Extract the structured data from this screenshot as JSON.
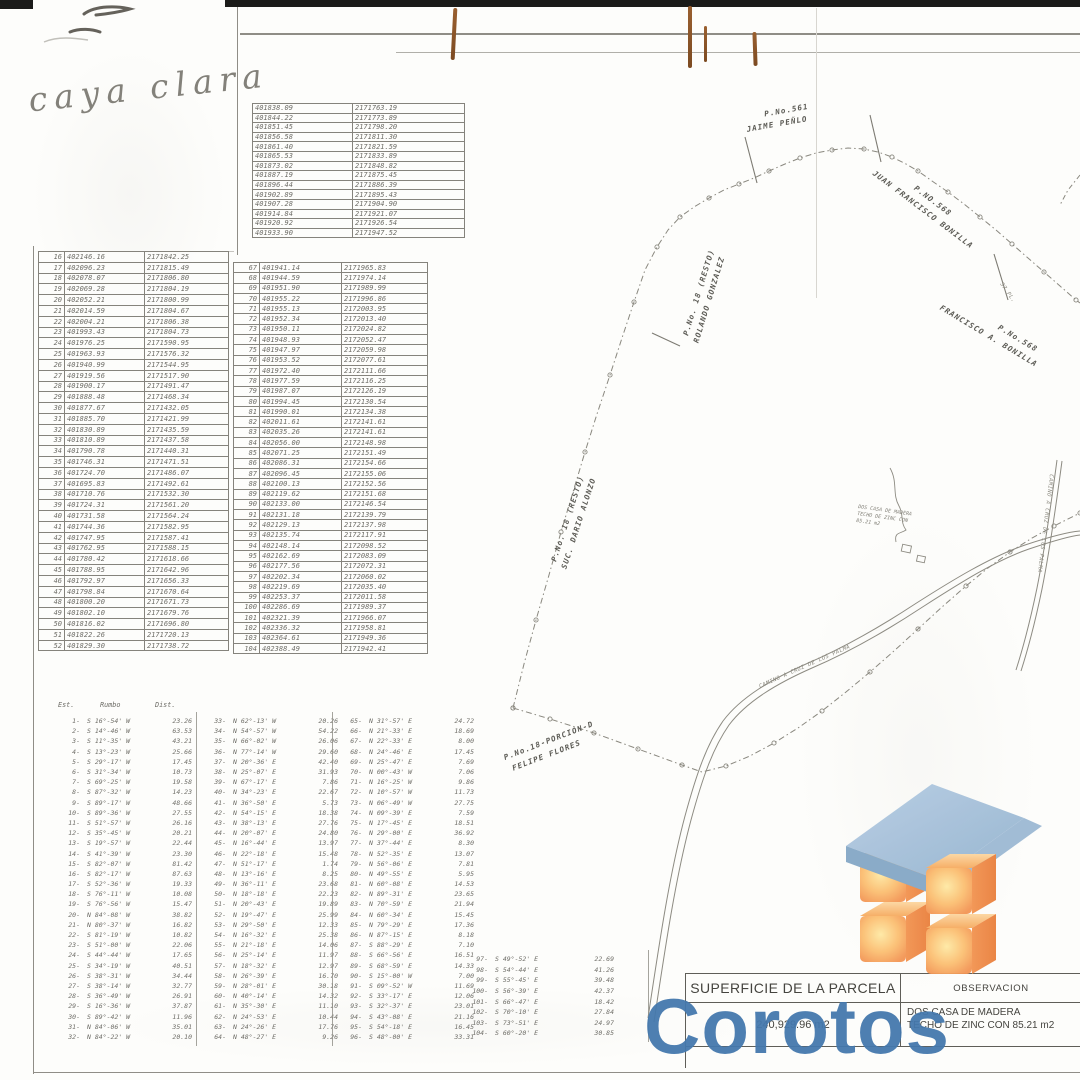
{
  "handwriting": {
    "text": "caya clara"
  },
  "top_table": {
    "rows": [
      [
        "401838.09",
        "2171763.19"
      ],
      [
        "401844.22",
        "2171773.89"
      ],
      [
        "401851.45",
        "2171798.20"
      ],
      [
        "401856.58",
        "2171811.30"
      ],
      [
        "401861.40",
        "2171821.59"
      ],
      [
        "401865.53",
        "2171833.89"
      ],
      [
        "401873.02",
        "2171848.82"
      ],
      [
        "401887.19",
        "2171875.45"
      ],
      [
        "401896.44",
        "2171886.39"
      ],
      [
        "401902.89",
        "2171895.43"
      ],
      [
        "401907.28",
        "2171904.90"
      ],
      [
        "401914.84",
        "2171921.07"
      ],
      [
        "401920.92",
        "2171926.54"
      ],
      [
        "401933.90",
        "2171947.52"
      ]
    ]
  },
  "left_table": {
    "rows": [
      [
        "16",
        "402146.16",
        "2171842.25"
      ],
      [
        "17",
        "402096.23",
        "2171815.49"
      ],
      [
        "18",
        "402078.07",
        "2171806.80"
      ],
      [
        "19",
        "402069.28",
        "2171804.19"
      ],
      [
        "20",
        "402052.21",
        "2171800.99"
      ],
      [
        "21",
        "402014.59",
        "2171804.67"
      ],
      [
        "22",
        "402004.21",
        "2171806.38"
      ],
      [
        "23",
        "401993.43",
        "2171804.73"
      ],
      [
        "24",
        "401976.25",
        "2171590.95"
      ],
      [
        "25",
        "401963.93",
        "2171576.32"
      ],
      [
        "26",
        "401940.99",
        "2171544.95"
      ],
      [
        "27",
        "401919.56",
        "2171517.90"
      ],
      [
        "28",
        "401900.17",
        "2171491.47"
      ],
      [
        "29",
        "401888.48",
        "2171468.34"
      ],
      [
        "30",
        "401877.67",
        "2171432.05"
      ],
      [
        "31",
        "401885.70",
        "2171421.99"
      ],
      [
        "32",
        "401830.89",
        "2171435.59"
      ],
      [
        "33",
        "401810.89",
        "2171437.58"
      ],
      [
        "34",
        "401790.78",
        "2171440.31"
      ],
      [
        "35",
        "401746.31",
        "2171471.51"
      ],
      [
        "36",
        "401724.70",
        "2171486.07"
      ],
      [
        "37",
        "401695.83",
        "2171492.61"
      ],
      [
        "38",
        "401710.76",
        "2171532.30"
      ],
      [
        "39",
        "401724.31",
        "2171561.20"
      ],
      [
        "40",
        "401731.58",
        "2171564.24"
      ],
      [
        "41",
        "401744.36",
        "2171582.95"
      ],
      [
        "42",
        "401747.95",
        "2171587.41"
      ],
      [
        "43",
        "401762.95",
        "2171588.15"
      ],
      [
        "44",
        "401780.42",
        "2171618.66"
      ],
      [
        "45",
        "401788.95",
        "2171642.96"
      ],
      [
        "46",
        "401792.97",
        "2171656.33"
      ],
      [
        "47",
        "401798.84",
        "2171670.64"
      ],
      [
        "48",
        "401800.20",
        "2171671.73"
      ],
      [
        "49",
        "401802.10",
        "2171679.76"
      ],
      [
        "50",
        "401816.02",
        "2171696.80"
      ],
      [
        "51",
        "401822.26",
        "2171720.13"
      ],
      [
        "52",
        "401829.30",
        "2171738.72"
      ]
    ]
  },
  "mid_table": {
    "rows": [
      [
        "67",
        "401941.14",
        "2171965.83"
      ],
      [
        "68",
        "401944.59",
        "2171974.14"
      ],
      [
        "69",
        "401951.90",
        "2171989.99"
      ],
      [
        "70",
        "401955.22",
        "2171996.86"
      ],
      [
        "71",
        "401955.13",
        "2172003.95"
      ],
      [
        "72",
        "401952.34",
        "2172013.40"
      ],
      [
        "73",
        "401950.11",
        "2172024.82"
      ],
      [
        "74",
        "401948.93",
        "2172052.47"
      ],
      [
        "75",
        "401947.97",
        "2172059.98"
      ],
      [
        "76",
        "401953.52",
        "2172077.61"
      ],
      [
        "77",
        "401972.40",
        "2172111.66"
      ],
      [
        "78",
        "401977.59",
        "2172116.25"
      ],
      [
        "79",
        "401987.07",
        "2172126.19"
      ],
      [
        "80",
        "401994.45",
        "2172130.54"
      ],
      [
        "81",
        "401990.01",
        "2172134.38"
      ],
      [
        "82",
        "402011.61",
        "2172141.61"
      ],
      [
        "83",
        "402035.26",
        "2172141.61"
      ],
      [
        "84",
        "402056.00",
        "2172148.98"
      ],
      [
        "85",
        "402071.25",
        "2172151.49"
      ],
      [
        "86",
        "402086.31",
        "2172154.66"
      ],
      [
        "87",
        "402096.45",
        "2172155.06"
      ],
      [
        "88",
        "402100.13",
        "2172152.56"
      ],
      [
        "89",
        "402119.62",
        "2172151.68"
      ],
      [
        "90",
        "402133.00",
        "2172146.54"
      ],
      [
        "91",
        "402131.18",
        "2172139.79"
      ],
      [
        "92",
        "402129.13",
        "2172137.98"
      ],
      [
        "93",
        "402135.74",
        "2172117.91"
      ],
      [
        "94",
        "402148.14",
        "2172098.52"
      ],
      [
        "95",
        "402162.69",
        "2172083.09"
      ],
      [
        "96",
        "402177.56",
        "2172072.31"
      ],
      [
        "97",
        "402202.34",
        "2172060.02"
      ],
      [
        "98",
        "402219.69",
        "2172035.40"
      ],
      [
        "99",
        "402253.37",
        "2172011.58"
      ],
      [
        "100",
        "402286.69",
        "2171989.37"
      ],
      [
        "101",
        "402321.39",
        "2171966.07"
      ],
      [
        "102",
        "402336.32",
        "2171958.81"
      ],
      [
        "103",
        "402364.61",
        "2171949.36"
      ],
      [
        "104",
        "402388.49",
        "2171942.41"
      ]
    ]
  },
  "bearings": {
    "headers": {
      "est": "Est.",
      "rumbo": "Rumbo",
      "dist": "Dist."
    },
    "group1": [
      [
        "1-",
        "S 16°-54' W",
        "23.26"
      ],
      [
        "2-",
        "S 14°-46' W",
        "63.53"
      ],
      [
        "3-",
        "S 11°-35' W",
        "43.21"
      ],
      [
        "4-",
        "S 13°-23' W",
        "25.66"
      ],
      [
        "5-",
        "S 29°-17' W",
        "17.45"
      ],
      [
        "6-",
        "S 31°-34' W",
        "10.73"
      ],
      [
        "7-",
        "S 69°-25' W",
        "19.58"
      ],
      [
        "8-",
        "S 87°-32' W",
        "14.23"
      ],
      [
        "9-",
        "S 89°-17' W",
        "48.66"
      ],
      [
        "10-",
        "S 89°-36' W",
        "27.55"
      ],
      [
        "11-",
        "S 51°-57' W",
        "26.16"
      ],
      [
        "12-",
        "S 35°-45' W",
        "20.21"
      ],
      [
        "13-",
        "S 19°-57' W",
        "22.44"
      ],
      [
        "14-",
        "S 41°-39' W",
        "23.30"
      ],
      [
        "15-",
        "S 82°-07' W",
        "81.42"
      ],
      [
        "16-",
        "S 82°-17' W",
        "87.63"
      ],
      [
        "17-",
        "S 52°-36' W",
        "19.33"
      ],
      [
        "18-",
        "S 76°-11' W",
        "10.08"
      ],
      [
        "19-",
        "S 76°-56' W",
        "15.47"
      ],
      [
        "20-",
        "N 84°-08' W",
        "38.82"
      ],
      [
        "21-",
        "N 80°-37' W",
        "16.82"
      ],
      [
        "22-",
        "S 81°-19' W",
        "10.82"
      ],
      [
        "23-",
        "S 51°-00' W",
        "22.06"
      ],
      [
        "24-",
        "S 44°-44' W",
        "17.65"
      ],
      [
        "25-",
        "S 34°-19' W",
        "40.51"
      ],
      [
        "26-",
        "S 38°-31' W",
        "34.44"
      ],
      [
        "27-",
        "S 38°-14' W",
        "32.77"
      ],
      [
        "28-",
        "S 36°-49' W",
        "26.91"
      ],
      [
        "29-",
        "S 16°-36' W",
        "37.87"
      ],
      [
        "30-",
        "S 89°-42' W",
        "11.96"
      ],
      [
        "31-",
        "N 84°-06' W",
        "35.01"
      ],
      [
        "32-",
        "N 84°-22' W",
        "20.10"
      ]
    ],
    "group2": [
      [
        "33-",
        "N 62°-13' W",
        "20.26"
      ],
      [
        "34-",
        "N 54°-57' W",
        "54.22"
      ],
      [
        "35-",
        "N 66°-02' W",
        "26.06"
      ],
      [
        "36-",
        "N 77°-14' W",
        "29.60"
      ],
      [
        "37-",
        "N 20°-36' E",
        "42.40"
      ],
      [
        "38-",
        "N 25°-07' E",
        "31.93"
      ],
      [
        "39-",
        "N 67°-17' E",
        "7.86"
      ],
      [
        "40-",
        "N 34°-23' E",
        "22.67"
      ],
      [
        "41-",
        "N 36°-50' E",
        "5.73"
      ],
      [
        "42-",
        "N 54°-15' E",
        "18.38"
      ],
      [
        "43-",
        "N 38°-13' E",
        "27.76"
      ],
      [
        "44-",
        "N 20°-07' E",
        "24.80"
      ],
      [
        "45-",
        "N 16°-44' E",
        "13.97"
      ],
      [
        "46-",
        "N 22°-18' E",
        "15.48"
      ],
      [
        "47-",
        "N 51°-17' E",
        "1.74"
      ],
      [
        "48-",
        "N 13°-16' E",
        "8.25"
      ],
      [
        "49-",
        "N 36°-11' E",
        "23.68"
      ],
      [
        "50-",
        "N 18°-18' E",
        "22.23"
      ],
      [
        "51-",
        "N 20°-43' E",
        "19.89"
      ],
      [
        "52-",
        "N 19°-47' E",
        "25.99"
      ],
      [
        "53-",
        "N 29°-50' E",
        "12.33"
      ],
      [
        "54-",
        "N 16°-32' E",
        "25.38"
      ],
      [
        "55-",
        "N 21°-18' E",
        "14.06"
      ],
      [
        "56-",
        "N 25°-14' E",
        "11.97"
      ],
      [
        "57-",
        "N 18°-32' E",
        "12.97"
      ],
      [
        "58-",
        "N 26°-39' E",
        "16.70"
      ],
      [
        "59-",
        "N 28°-01' E",
        "30.18"
      ],
      [
        "60-",
        "N 40°-14' E",
        "14.32"
      ],
      [
        "61-",
        "N 35°-30' E",
        "11.10"
      ],
      [
        "62-",
        "N 24°-53' E",
        "10.44"
      ],
      [
        "63-",
        "N 24°-26' E",
        "17.76"
      ],
      [
        "64-",
        "N 48°-27' E",
        "9.26"
      ]
    ],
    "group3": [
      [
        "65-",
        "N 31°-57' E",
        "24.72"
      ],
      [
        "66-",
        "N 21°-33' E",
        "18.69"
      ],
      [
        "67-",
        "N 22°-33' E",
        "8.00"
      ],
      [
        "68-",
        "N 24°-46' E",
        "17.45"
      ],
      [
        "69-",
        "N 25°-47' E",
        "7.69"
      ],
      [
        "70-",
        "N 00°-43' W",
        "7.06"
      ],
      [
        "71-",
        "N 16°-25' W",
        "9.86"
      ],
      [
        "72-",
        "N 10°-57' W",
        "11.73"
      ],
      [
        "73-",
        "N 06°-49' W",
        "27.75"
      ],
      [
        "74-",
        "N 09°-39' E",
        "7.59"
      ],
      [
        "75-",
        "N 17°-45' E",
        "18.51"
      ],
      [
        "76-",
        "N 29°-00' E",
        "36.92"
      ],
      [
        "77-",
        "N 37°-44' E",
        "8.30"
      ],
      [
        "78-",
        "N 52°-35' E",
        "13.07"
      ],
      [
        "79-",
        "N 56°-06' E",
        "7.81"
      ],
      [
        "80-",
        "N 49°-55' E",
        "5.95"
      ],
      [
        "81-",
        "N 60°-08' E",
        "14.53"
      ],
      [
        "82-",
        "N 89°-31' E",
        "23.65"
      ],
      [
        "83-",
        "N 70°-59' E",
        "21.94"
      ],
      [
        "84-",
        "N 60°-34' E",
        "15.45"
      ],
      [
        "85-",
        "N 79°-29' E",
        "17.36"
      ],
      [
        "86-",
        "N 87°-15' E",
        "8.18"
      ],
      [
        "87-",
        "S 88°-29' E",
        "7.10"
      ],
      [
        "88-",
        "S 66°-56' E",
        "16.51"
      ],
      [
        "89-",
        "S 68°-59' E",
        "14.33"
      ],
      [
        "90-",
        "S 15°-00' W",
        "7.00"
      ],
      [
        "91-",
        "S 09°-52' W",
        "11.69"
      ],
      [
        "92-",
        "S 33°-17' E",
        "12.06"
      ],
      [
        "93-",
        "S 32°-37' E",
        "23.01"
      ],
      [
        "94-",
        "S 43°-08' E",
        "21.16"
      ],
      [
        "95-",
        "S 54°-18' E",
        "16.45"
      ],
      [
        "96-",
        "S 48°-00' E",
        "33.31"
      ]
    ],
    "group4": [
      [
        "97-",
        "S 49°-52' E",
        "22.69"
      ],
      [
        "98-",
        "S 54°-44' E",
        "41.26"
      ],
      [
        "99-",
        "S 55°-45' E",
        "39.48"
      ],
      [
        "100-",
        "S 56°-39' E",
        "42.37"
      ],
      [
        "101-",
        "S 66°-47' E",
        "18.42"
      ],
      [
        "102-",
        "S 70°-10' E",
        "27.84"
      ],
      [
        "103-",
        "S 73°-51' E",
        "24.97"
      ],
      [
        "104-",
        "S 60°-20' E",
        "30.85"
      ]
    ]
  },
  "summary": {
    "superficie_header": "SUPERFICIE DE LA PARCELA",
    "observacion_header": "OBSERVACION",
    "area_value": "240,929.96 m2",
    "observacion_line1": "DOS CASA DE MADERA",
    "observacion_line2": "TECHO DE ZINC CON 85.21 m2"
  },
  "map": {
    "labels": {
      "jaime": {
        "line1": "P.No.561",
        "line2": "JAIME PEÑLO"
      },
      "juan": {
        "line1": "P.NO.568",
        "line2": "JUAN FRANCISCO BONILLA"
      },
      "francisco": {
        "line1": "P.No.568",
        "line2": "FRANCISCO A. BONILLA"
      },
      "rolando": {
        "line1": "P.No. 18 (RESTO)",
        "line2": "ROLANDO GONZALEZ"
      },
      "dario": {
        "line1": "P.No. 18 (RESTO)",
        "line2": "SUC. DARIO ALONZO"
      },
      "felipe": {
        "line1": "P.No.18-PORCION-D",
        "line2": "FELIPE FLORES"
      },
      "pl37": "37 PL.",
      "road_a": "CAMINO A CRUZ DE LOS PALMA",
      "road_b": "CAMINO A CRUZ DE LOS PALMA",
      "note_line1": "DOS CASA DE MADERA",
      "note_line2": "TECHO DE ZINC CON",
      "note_line3": "85.21 m2"
    }
  },
  "watermark": {
    "wordmark": "Corotos"
  },
  "colors": {
    "watermark_blue": "#4478ad",
    "cube_orange": "#f7a258",
    "roof_blue": "#a8c2dc",
    "ink": "#6e6d67",
    "rust_brown": "#8a5628"
  }
}
